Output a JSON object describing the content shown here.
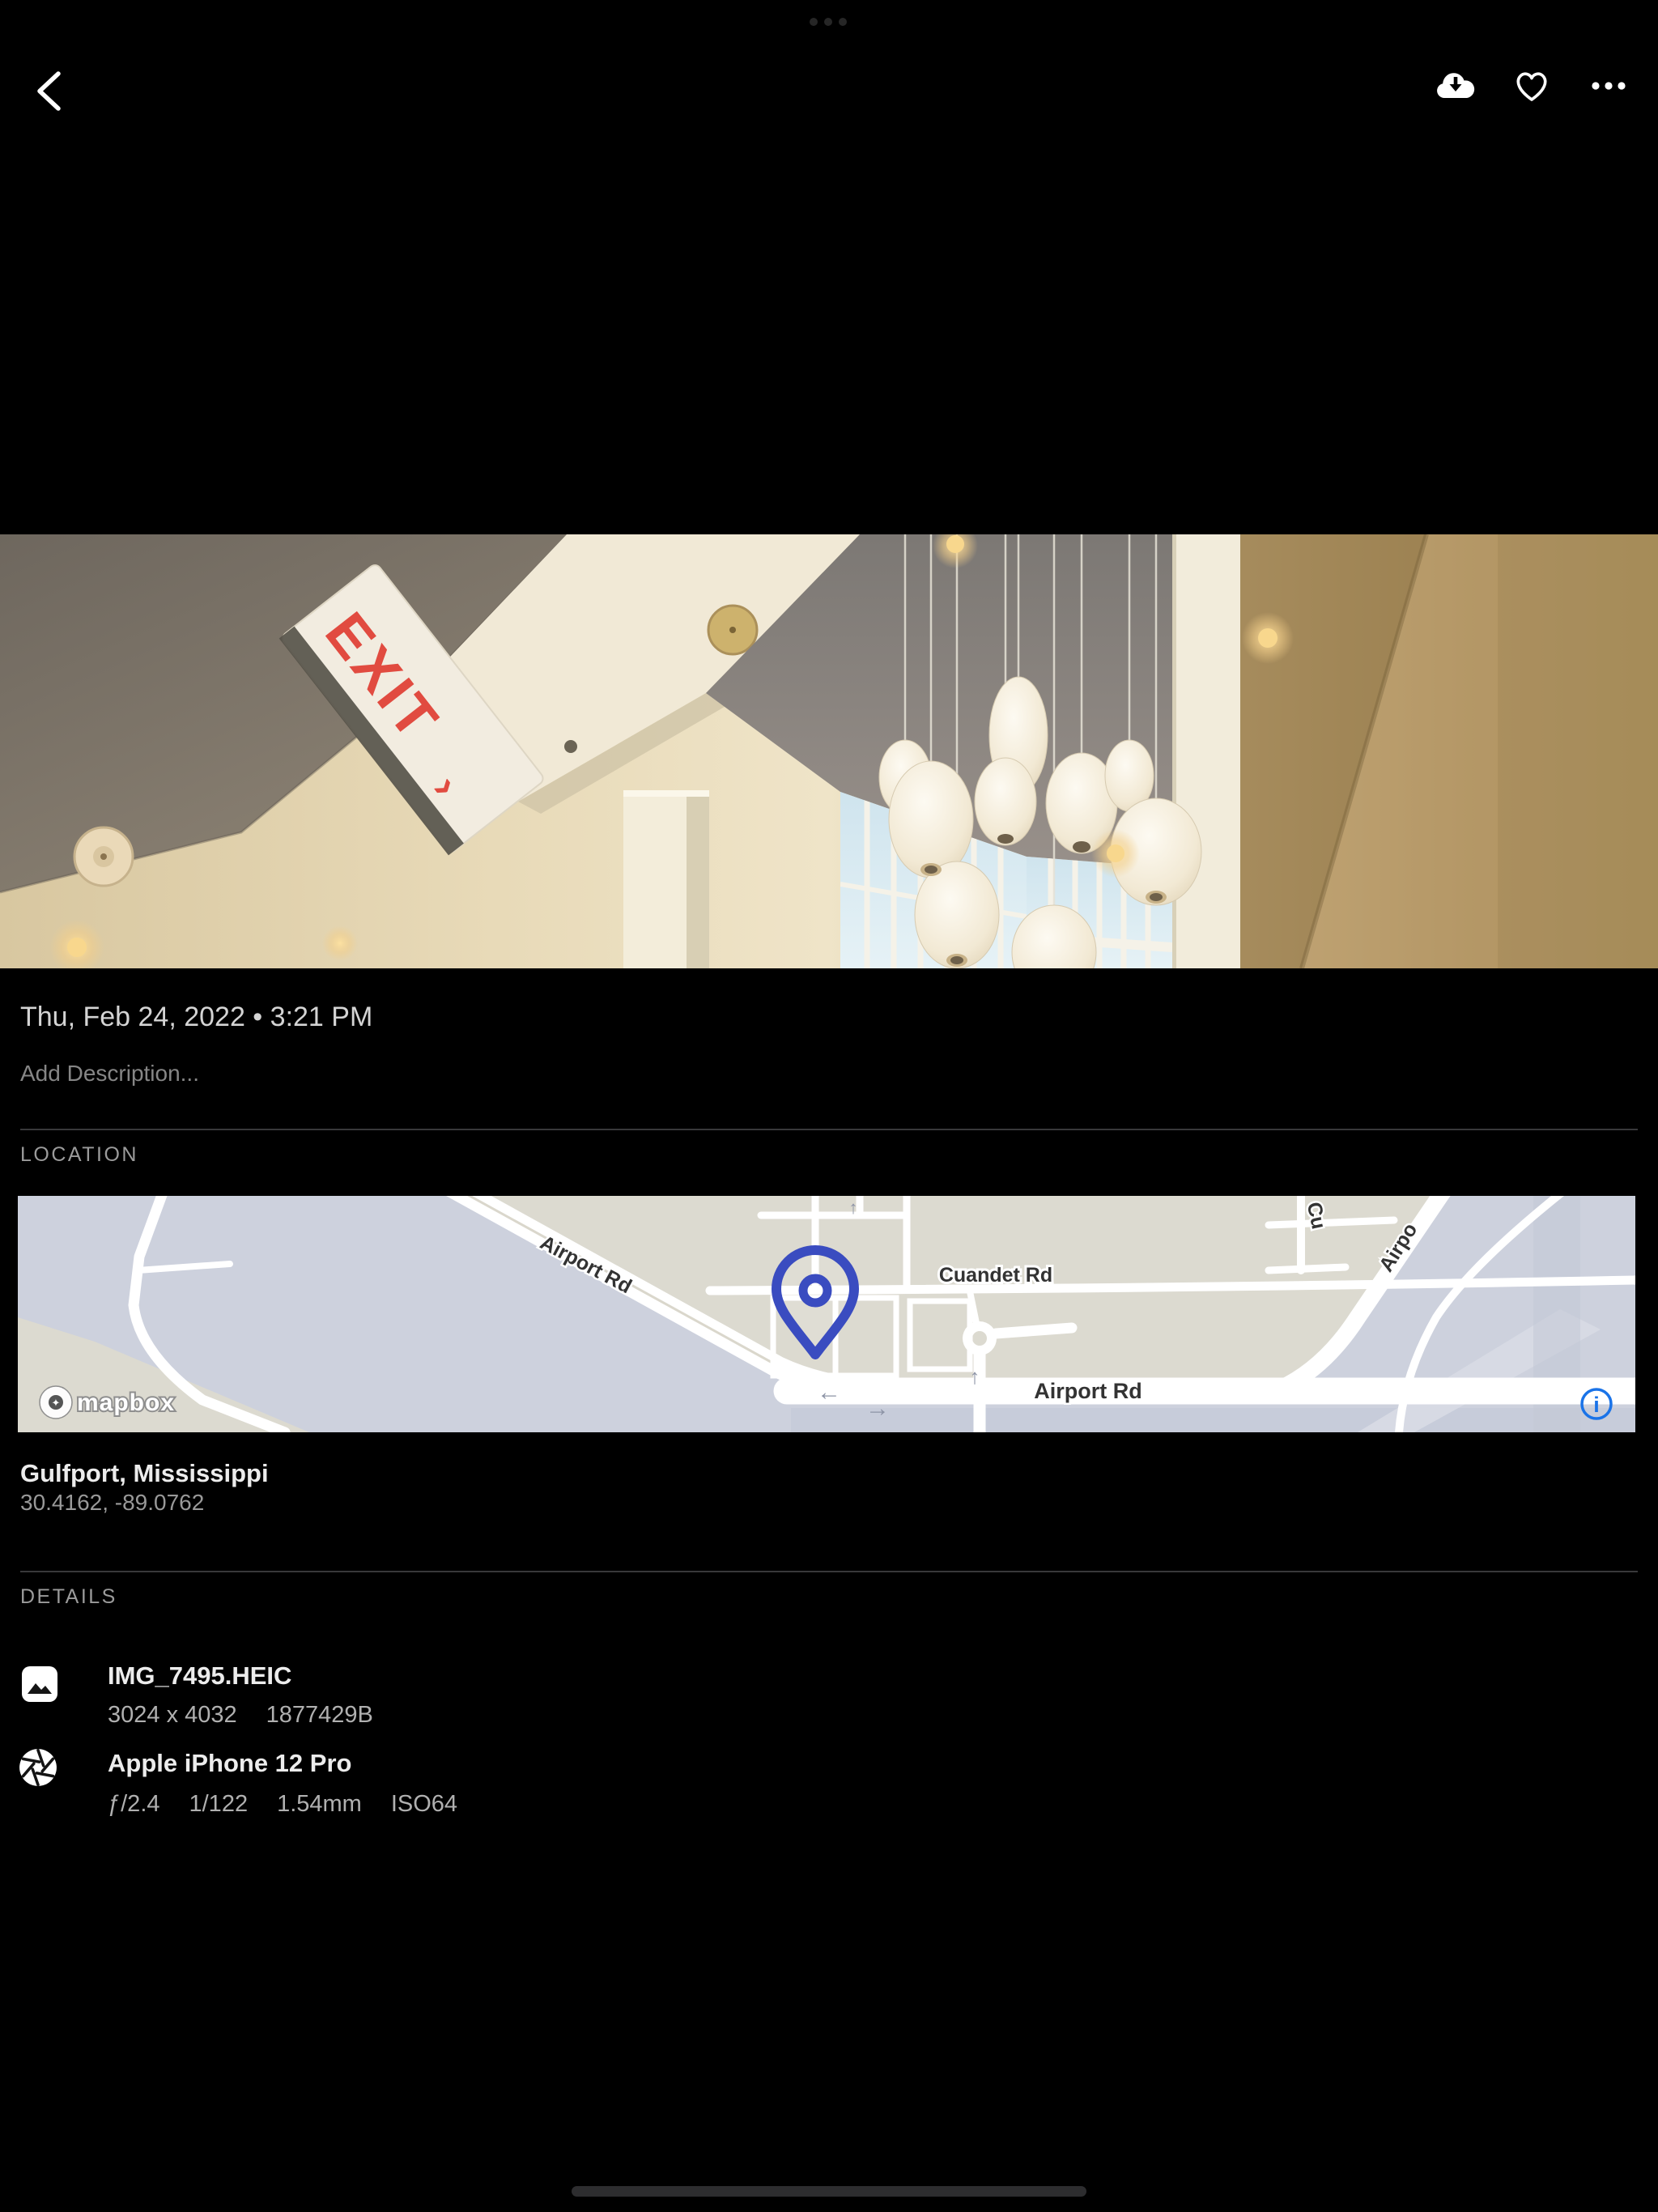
{
  "system": {
    "handle": "app-switcher-dots"
  },
  "topbar": {
    "back_icon": "chevron-left",
    "download_icon": "cloud-download",
    "favorite_icon": "heart-outline",
    "more_icon": "ellipsis-horizontal"
  },
  "photo": {
    "exit_sign": "EXIT",
    "exit_arrow": "›"
  },
  "info": {
    "date": "Thu, Feb 24, 2022 • 3:21 PM",
    "description_placeholder": "Add Description..."
  },
  "location": {
    "header": "LOCATION",
    "place": "Gulfport, Mississippi",
    "coordinates": "30.4162, -89.0762",
    "map": {
      "road_label_diagonal": "Airport Rd",
      "road_label_cuandet": "Cuandet Rd",
      "road_label_horizontal": "Airport Rd",
      "road_label_top_right": "Airpo",
      "road_label_top_right2": "Cu",
      "arrows": [
        "←",
        "→",
        "↑",
        "↑"
      ],
      "attribution": "mapbox",
      "attribution_glyph": "✦",
      "info_glyph": "i",
      "colors": {
        "land": "#dcdad0",
        "urban": "#cdd1dd",
        "road": "#ffffff",
        "pin": "#3a4cc0",
        "info_icon": "#1a73e8"
      }
    }
  },
  "details": {
    "header": "DETAILS",
    "file": {
      "icon": "image-icon",
      "title": "IMG_7495.HEIC",
      "dimensions": "3024 x 4032",
      "size": "1877429B"
    },
    "camera": {
      "icon": "aperture-icon",
      "title": "Apple iPhone 12 Pro",
      "aperture": "ƒ/2.4",
      "shutter": "1/122",
      "focal": "1.54mm",
      "iso": "ISO64"
    }
  }
}
